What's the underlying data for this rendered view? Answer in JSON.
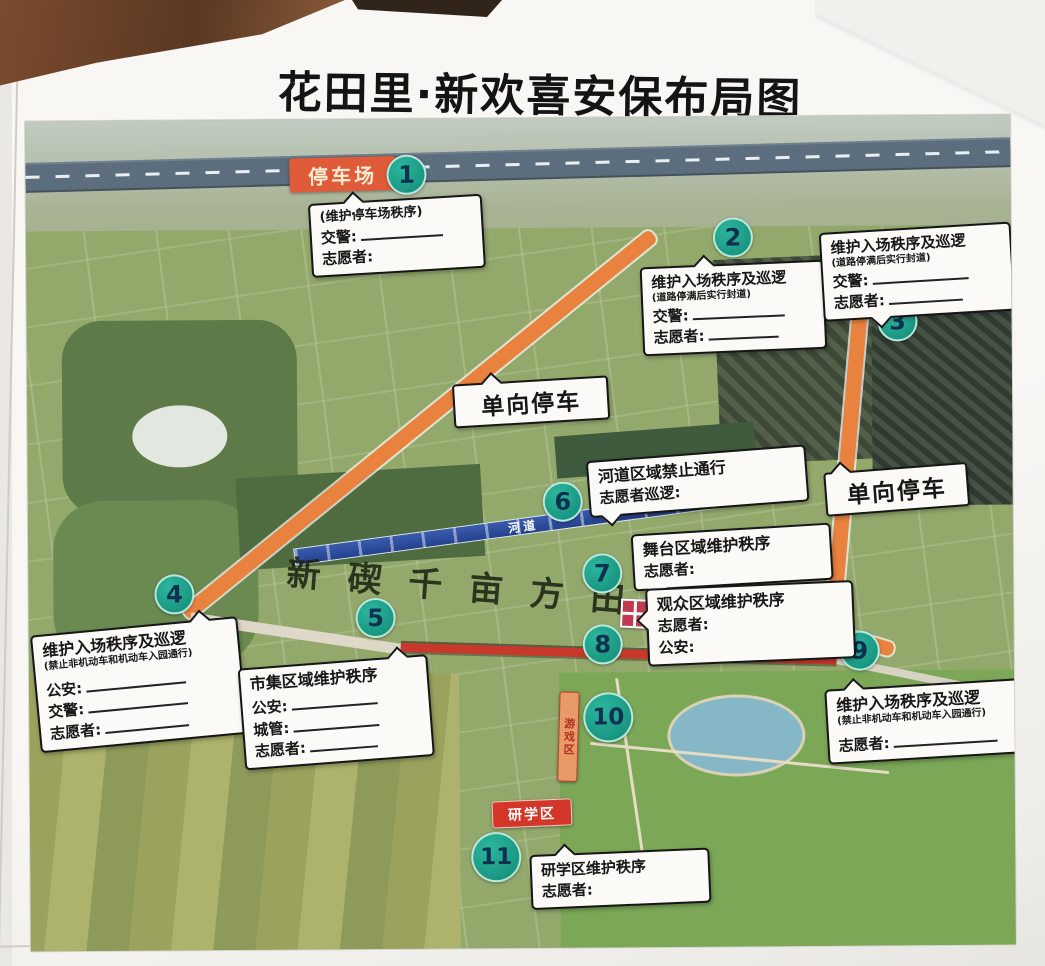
{
  "title": "花田里·新欢喜安保布局图",
  "labels": {
    "parking_lot": "停车场",
    "one_way_left": "单向停车",
    "one_way_right": "单向停车",
    "river": "河道",
    "game_zone": "游戏区",
    "study_zone": "研学区",
    "ground_text": "新碶千亩方田"
  },
  "markers": {
    "m1": "1",
    "m2": "2",
    "m3": "3",
    "m4": "4",
    "m5": "5",
    "m6": "6",
    "m7": "7",
    "m8": "8",
    "m9": "9",
    "m10": "10",
    "m11": "11"
  },
  "callouts": {
    "c1": {
      "subtitle": "(维护停车场秩序)",
      "f1": "交警:",
      "f2": "志愿者:"
    },
    "c2": {
      "title": "维护入场秩序及巡逻",
      "subtitle": "(道路停满后实行封道)",
      "f1": "交警:",
      "f2": "志愿者:"
    },
    "c3": {
      "title": "维护入场秩序及巡逻",
      "subtitle": "(道路停满后实行封道)",
      "f1": "交警:",
      "f2": "志愿者:"
    },
    "c4": {
      "title": "维护入场秩序及巡逻",
      "subtitle": "(禁止非机动车和机动车入园通行)",
      "f1": "公安:",
      "f2": "交警:",
      "f3": "志愿者:"
    },
    "c5": {
      "title": "市集区域维护秩序",
      "f1": "公安:",
      "f2": "城管:",
      "f3": "志愿者:"
    },
    "c6": {
      "title": "河道区域禁止通行",
      "f1": "志愿者巡逻:"
    },
    "c7": {
      "title": "舞台区域维护秩序",
      "f1": "志愿者:"
    },
    "c8": {
      "title": "观众区域维护秩序",
      "f1": "志愿者:",
      "f2": "公安:"
    },
    "c9": {
      "title": "维护入场秩序及巡逻",
      "subtitle": "(禁止非机动车和机动车入园通行)",
      "f1": "志愿者:"
    },
    "c11": {
      "title": "研学区维护秩序",
      "f1": "志愿者:"
    }
  },
  "colors": {
    "marker_teal": "#17a08b",
    "road_orange": "#e8823e",
    "river_blue": "#2a4a9e",
    "market_red": "#c8392b",
    "badge_red": "#d4372a",
    "parking_orange": "#e05b39"
  }
}
